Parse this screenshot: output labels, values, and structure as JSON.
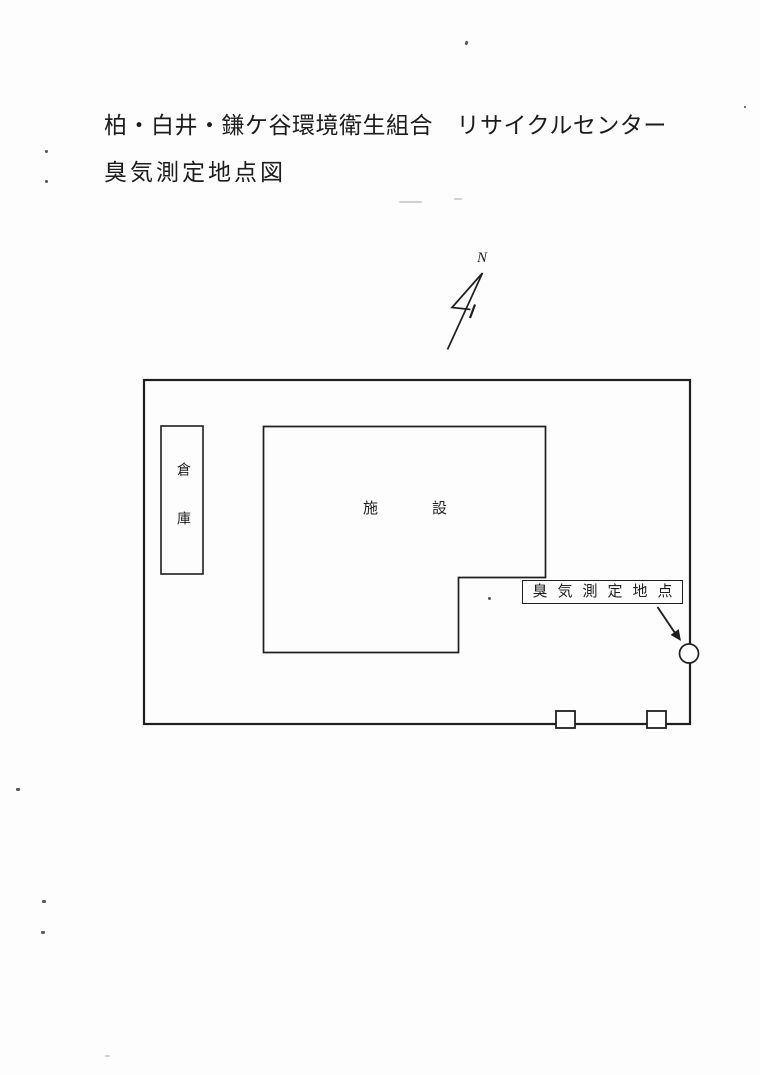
{
  "document": {
    "title_line1": "柏・白井・鎌ケ谷環境衛生組合　リサイクルセンター",
    "title_line2": "臭気測定地点図"
  },
  "compass": {
    "north_label": "N"
  },
  "site_plan": {
    "warehouse_label": "倉庫",
    "facility_label": "施設",
    "measurement_point_label": "臭気測定地点"
  },
  "colors": {
    "ink": "#1f1f1f",
    "paper": "#fdfdfd"
  }
}
